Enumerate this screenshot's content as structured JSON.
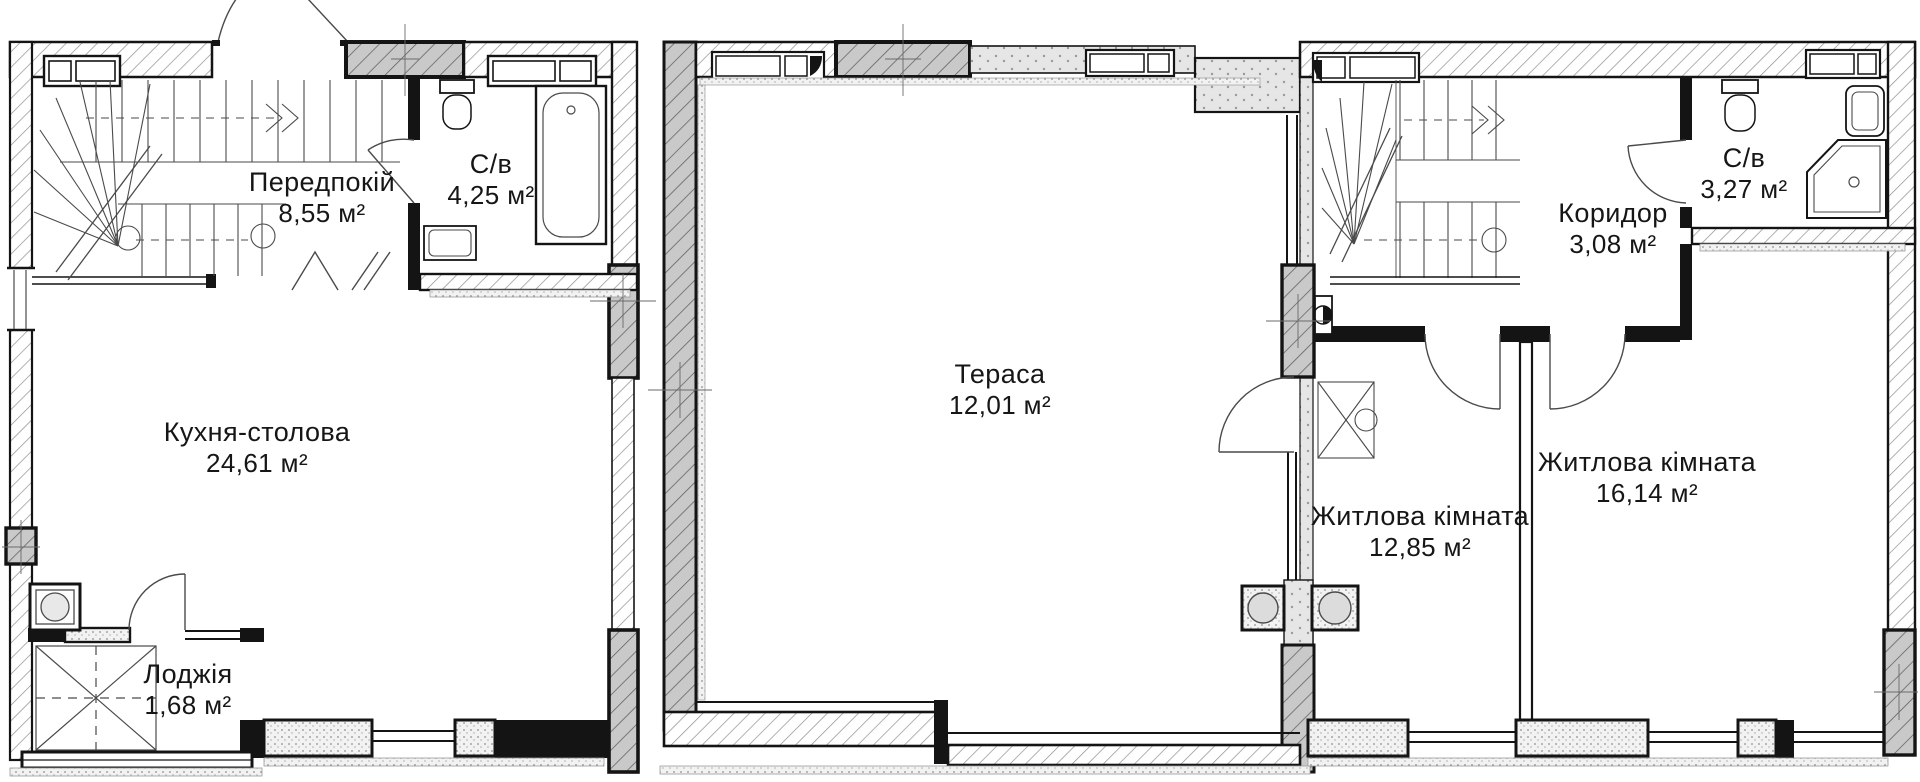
{
  "document": {
    "type": "apartment floor plan, two levels with terrace",
    "language": "uk"
  },
  "colors": {
    "background": "#ffffff",
    "wall_black": "#141414",
    "accent_concrete_grey": "#c9c9c9",
    "hatch_line": "#8f8f8f",
    "thin_line": "#4a4a4a",
    "text": "#161616"
  },
  "plans": [
    {
      "id": "level-1",
      "rooms": [
        {
          "name": "Передпокій",
          "area": "8,55 м²"
        },
        {
          "name": "С/в",
          "area": "4,25 м²"
        },
        {
          "name": "Кухня-столова",
          "area": "24,61 м²"
        },
        {
          "name": "Лоджія",
          "area": "1,68 м²"
        }
      ]
    },
    {
      "id": "terrace",
      "rooms": [
        {
          "name": "Тераса",
          "area": "12,01 м²"
        }
      ]
    },
    {
      "id": "level-2",
      "rooms": [
        {
          "name": "Коридор",
          "area": "3,08 м²"
        },
        {
          "name": "С/в",
          "area": "3,27 м²"
        },
        {
          "name": "Житлова кімната",
          "area": "12,85 м²"
        },
        {
          "name": "Житлова кімната",
          "area": "16,14 м²"
        }
      ]
    }
  ]
}
